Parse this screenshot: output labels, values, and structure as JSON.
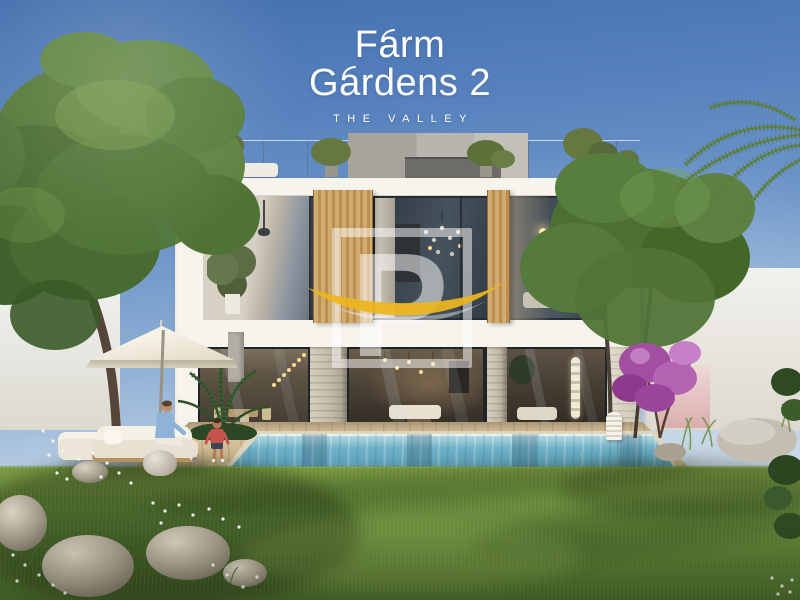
{
  "brand": {
    "name_line1": "Farm",
    "name_line2": "Gardens 2",
    "tagline": "THE VALLEY"
  },
  "watermark": {
    "letter": "P",
    "swoosh_color": "#ecb61d",
    "frame_color": "rgba(255,255,255,0.5)"
  },
  "palette": {
    "sky_top": "#4470af",
    "sky_horizon": "#d9e3ec",
    "villa_white": "#f6f3ec",
    "timber_slat": "#c9a265",
    "glass_dark": "#39434c",
    "stone_pillar": "#cbc3b2",
    "pool_water": "#6fb2c8",
    "deck_wood": "#d0bb93",
    "lawn_green": "#6a8c3c",
    "tree_green": "#55793a",
    "bougainvillea_purple": "#a855a8",
    "umbrella_cream": "#f3eee3"
  }
}
